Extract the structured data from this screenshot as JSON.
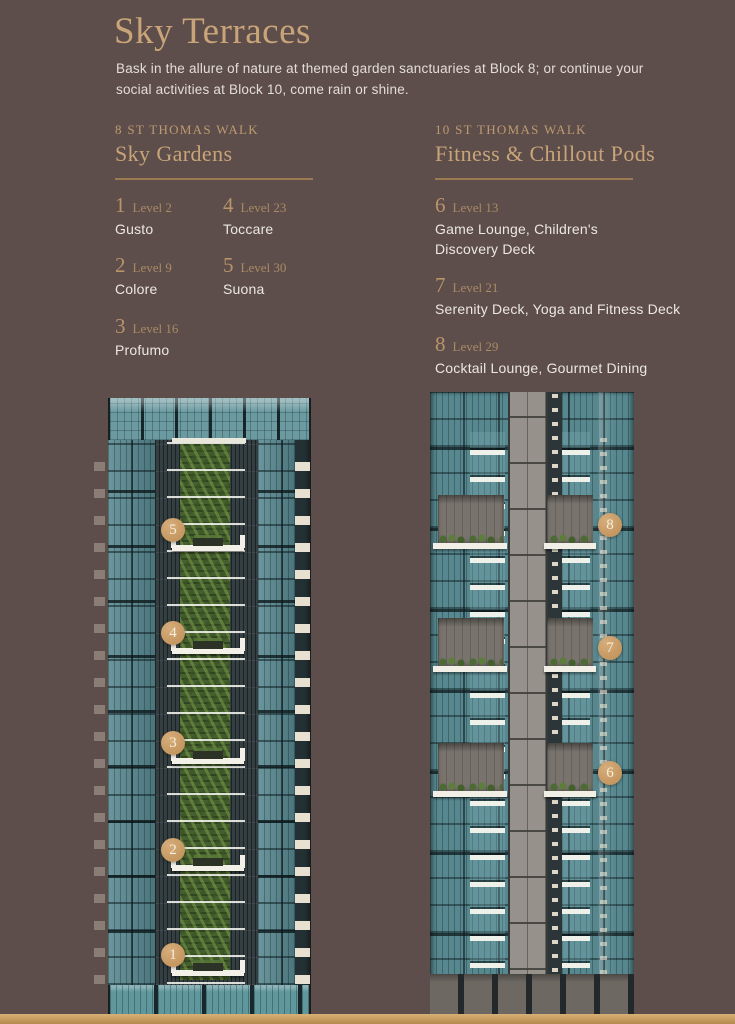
{
  "page": {
    "title": "Sky Terraces",
    "intro": "Bask in the allure of nature at themed garden sanctuaries at Block 8; or continue your social activities at Block 10, come rain or shine."
  },
  "palette": {
    "background": "#5d4e4b",
    "gold_heading": "#c8a478",
    "gold_rule": "#9a7a4e",
    "marker_fill": "#c79a64",
    "body_text": "#e4ddd7",
    "footer_bar": "#c49a5f",
    "glass_teal": "#57888f",
    "garden_green": "#465f2e"
  },
  "blocks": [
    {
      "eyebrow": "8 ST THOMAS WALK",
      "title": "Sky Gardens",
      "items": [
        {
          "num": "1",
          "level": "Level 2",
          "name": "Gusto"
        },
        {
          "num": "2",
          "level": "Level 9",
          "name": "Colore"
        },
        {
          "num": "3",
          "level": "Level 16",
          "name": "Profumo"
        },
        {
          "num": "4",
          "level": "Level 23",
          "name": "Toccare"
        },
        {
          "num": "5",
          "level": "Level 30",
          "name": "Suona"
        }
      ]
    },
    {
      "eyebrow": "10 ST THOMAS WALK",
      "title": "Fitness & Chillout Pods",
      "items": [
        {
          "num": "6",
          "level": "Level 13",
          "name": "Game Lounge, Children's Discovery Deck"
        },
        {
          "num": "7",
          "level": "Level 21",
          "name": "Serenity Deck, Yoga and Fitness Deck"
        },
        {
          "num": "8",
          "level": "Level 29",
          "name": "Cocktail Lounge, Gourmet Dining"
        }
      ]
    }
  ],
  "towers": [
    {
      "id": "block-8-tower",
      "markers": [
        {
          "num": "5",
          "x": 173,
          "y": 530
        },
        {
          "num": "4",
          "x": 173,
          "y": 633
        },
        {
          "num": "3",
          "x": 173,
          "y": 743
        },
        {
          "num": "2",
          "x": 173,
          "y": 850
        },
        {
          "num": "1",
          "x": 173,
          "y": 955
        }
      ]
    },
    {
      "id": "block-10-tower",
      "markers": [
        {
          "num": "8",
          "x": 610,
          "y": 525
        },
        {
          "num": "7",
          "x": 610,
          "y": 648
        },
        {
          "num": "6",
          "x": 610,
          "y": 773
        }
      ]
    }
  ]
}
